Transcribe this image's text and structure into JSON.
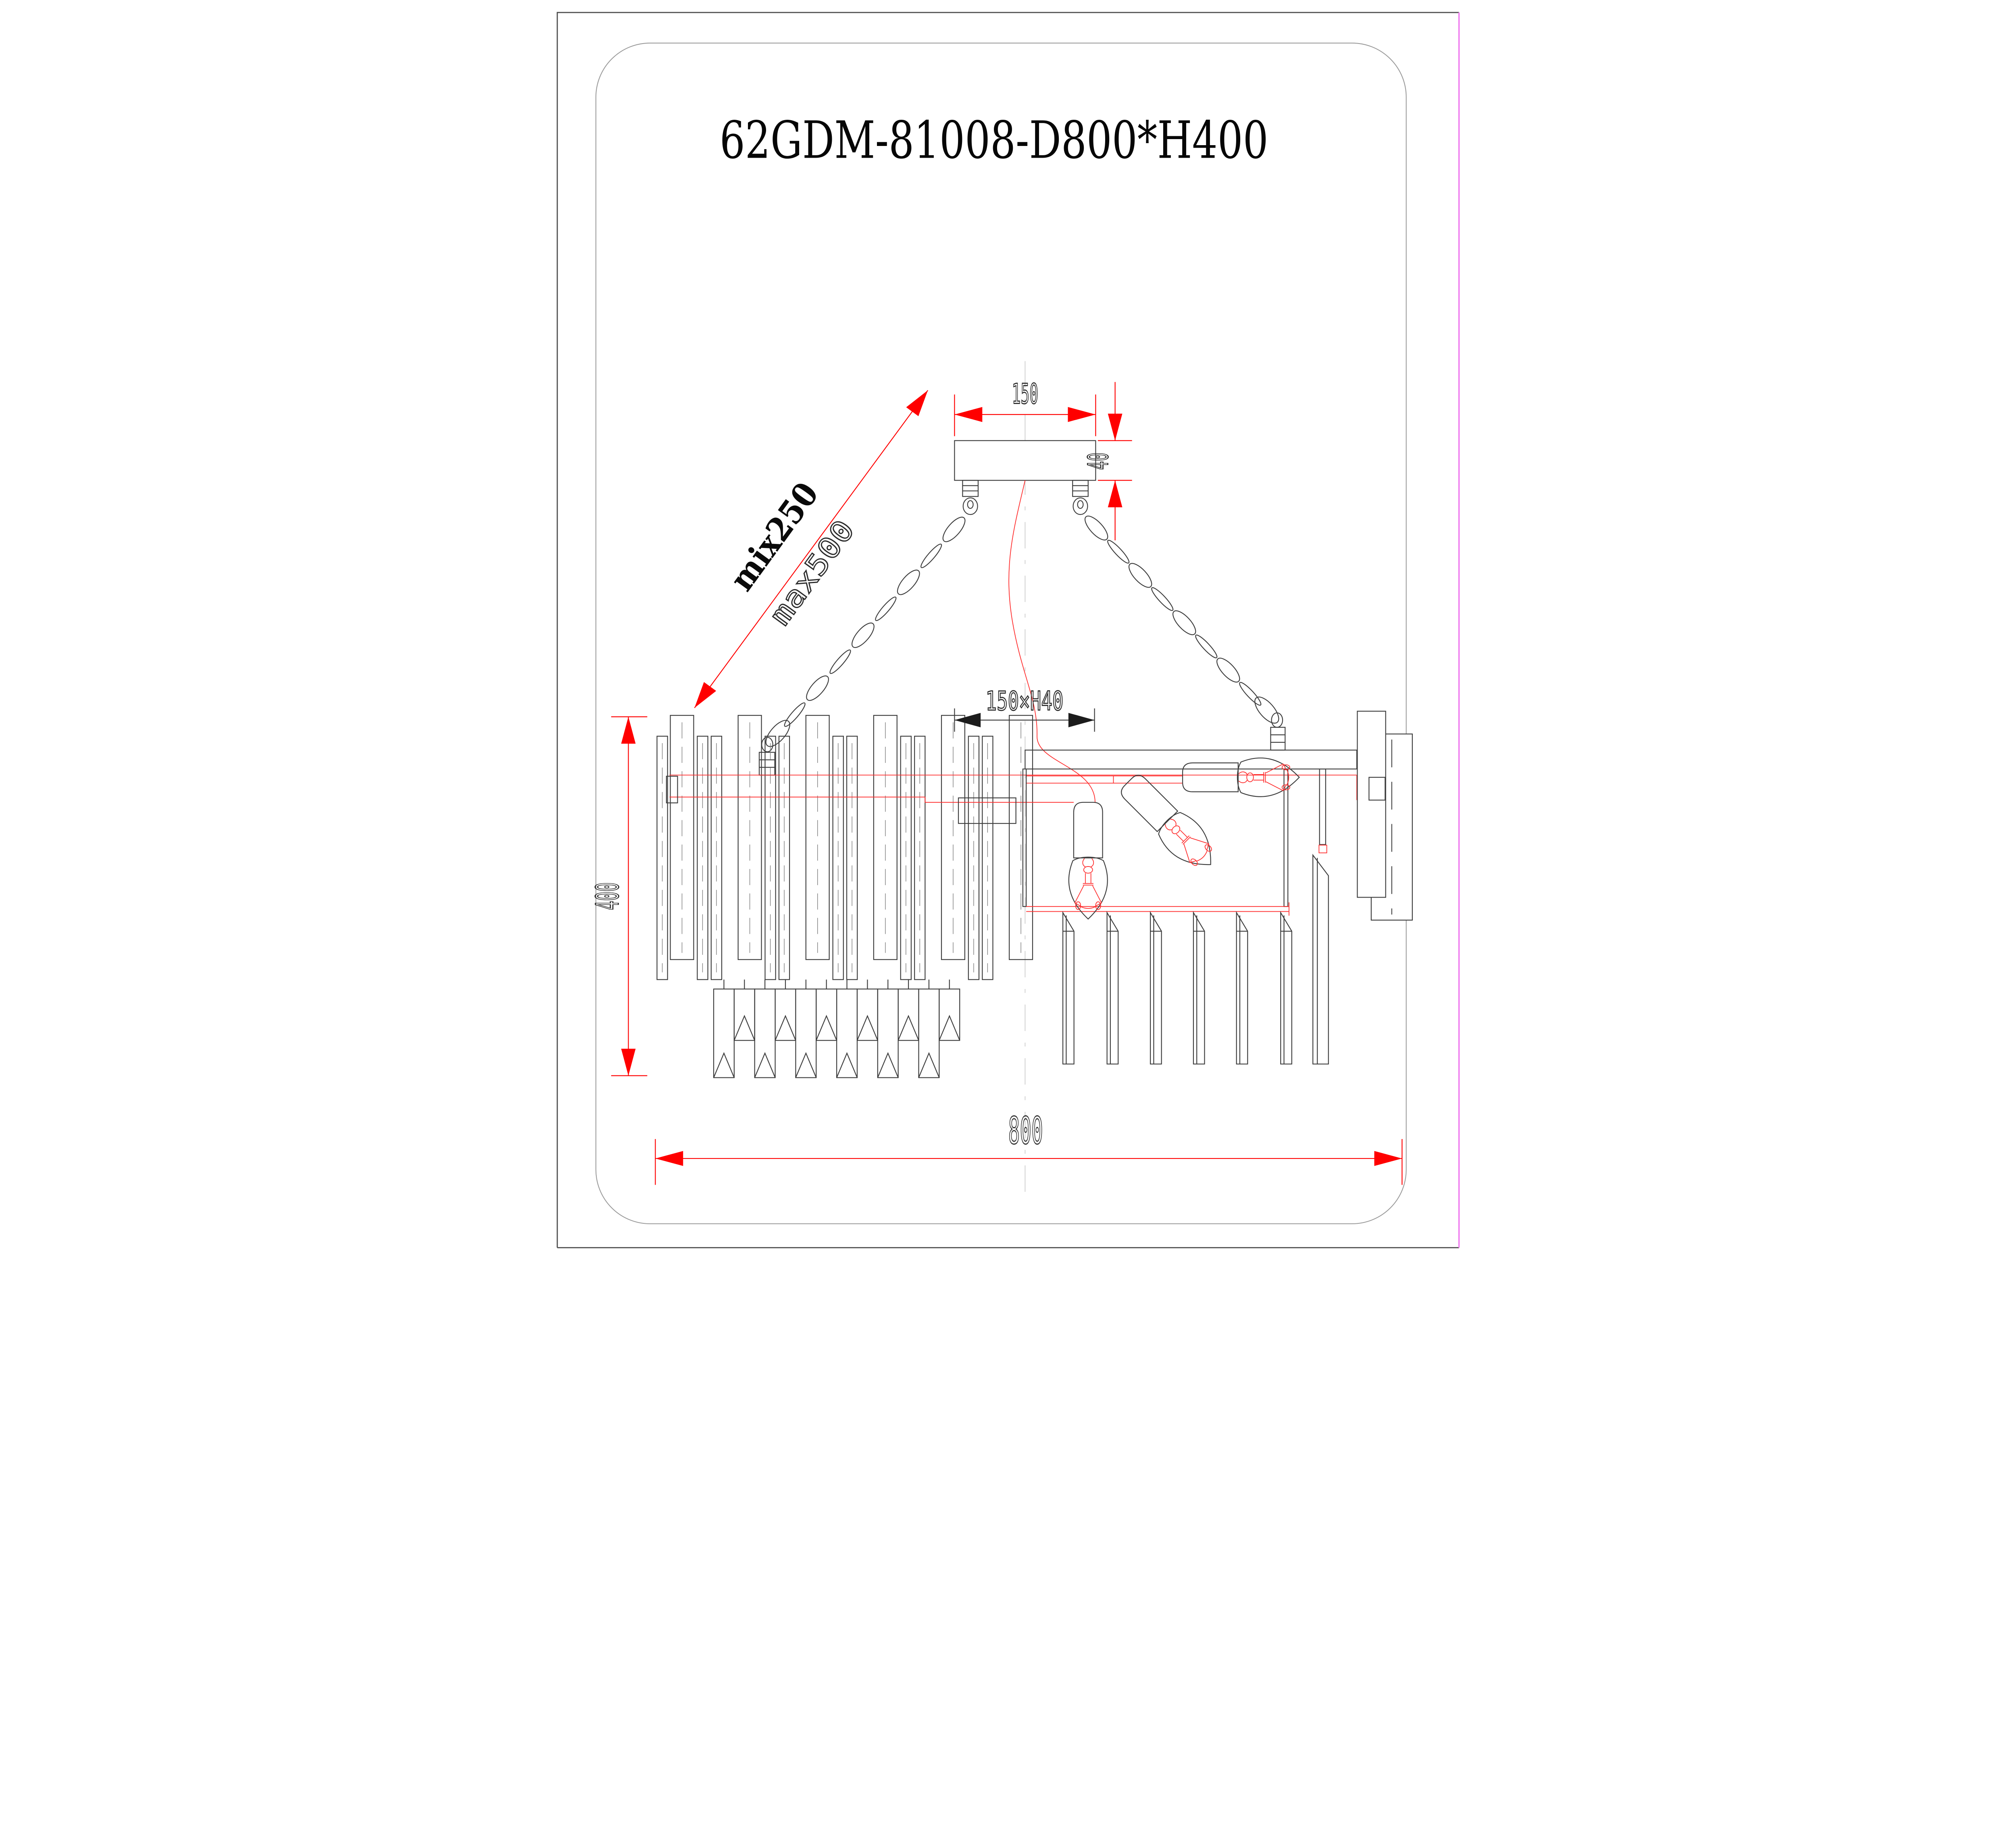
{
  "title": "62GDM-81008-D800*H400",
  "dimensions": {
    "canopy_width": "150",
    "canopy_height": "40",
    "suspension_min": "mix250",
    "suspension_max": "max500",
    "socket_spacing": "150×H40",
    "fixture_height": "400",
    "fixture_diameter": "800"
  },
  "colors": {
    "dimension_red": "#ff0000",
    "frame_red": "#ff2d2d",
    "drawing_ink": "#3d3d3d",
    "centerline_gray": "#c8c8c8",
    "inner_border_gray": "#9b9b9b",
    "page_edge_dark": "#4a4a4a",
    "page_edge_magenta": "#f07bf0"
  }
}
